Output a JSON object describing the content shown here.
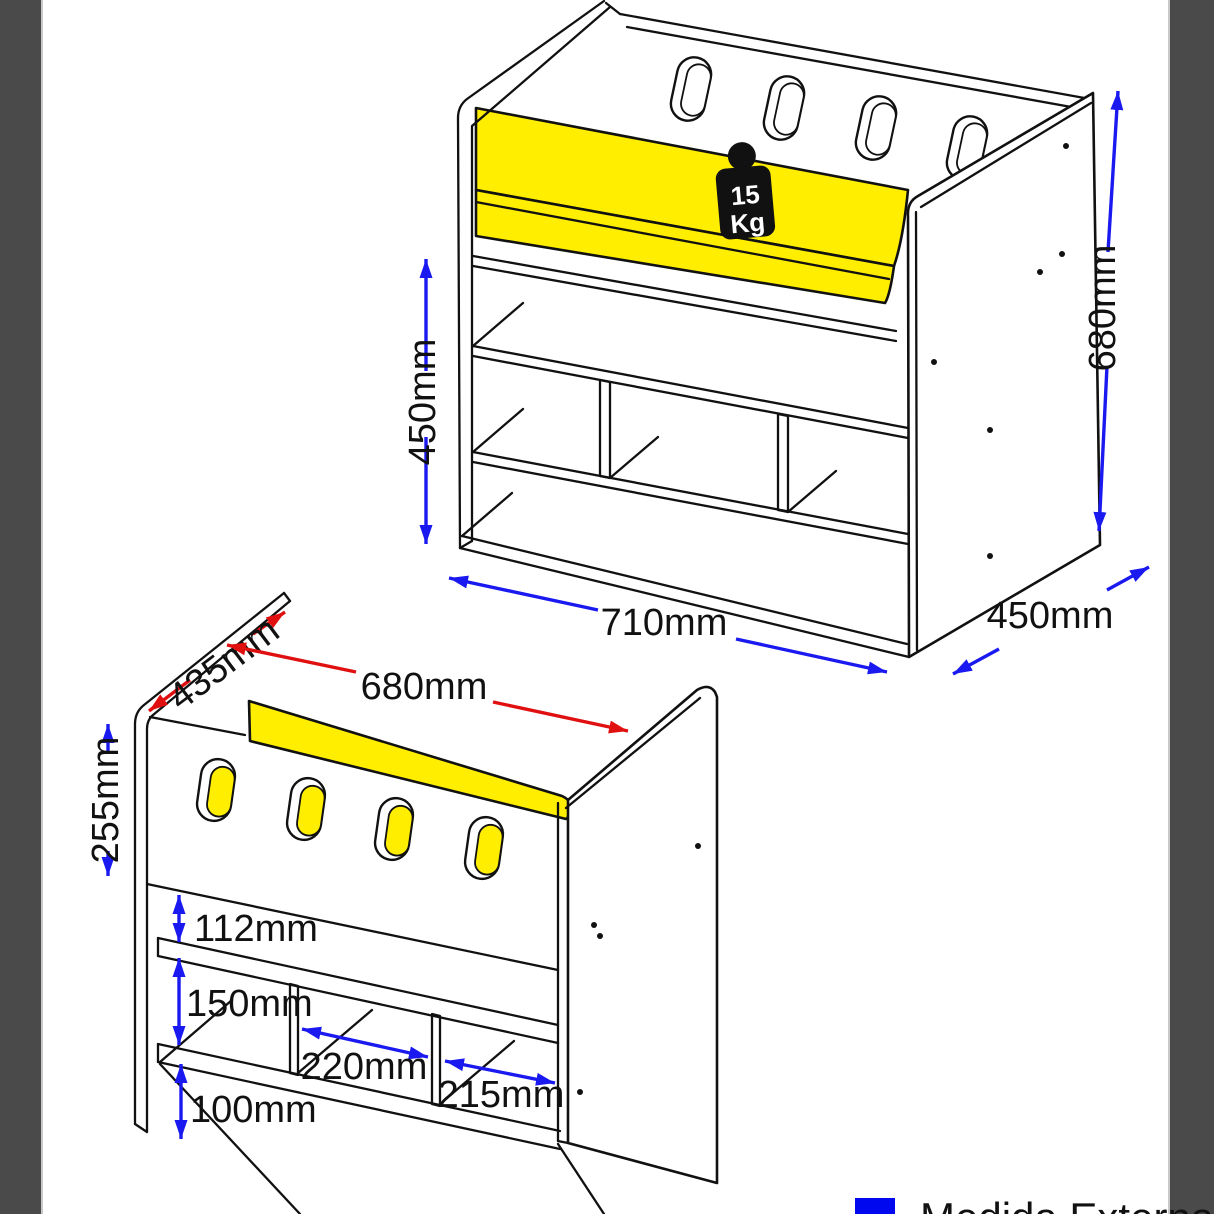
{
  "colors": {
    "seat_yellow": "#ffee00",
    "dimension_blue": "#1a1af0",
    "dimension_red": "#e01010",
    "side_border_gray": "#4a4a4a",
    "legend_external_blue": "#0008f0",
    "badge_black": "#111111"
  },
  "weight_badge": {
    "value": "15",
    "unit": "Kg"
  },
  "front_view": {
    "seat_height": "450mm",
    "total_height": "680mm",
    "width": "710mm",
    "depth": "450mm"
  },
  "back_view": {
    "depth": "435mm",
    "inner_width": "680mm",
    "panel_height": "255mm",
    "top_gap": "112mm",
    "middle_gap": "150mm",
    "bottom_gap": "100mm",
    "middle_cubby_width": "220mm",
    "right_cubby_width": "215mm"
  },
  "legend": {
    "external_label": "Medida Externa"
  }
}
